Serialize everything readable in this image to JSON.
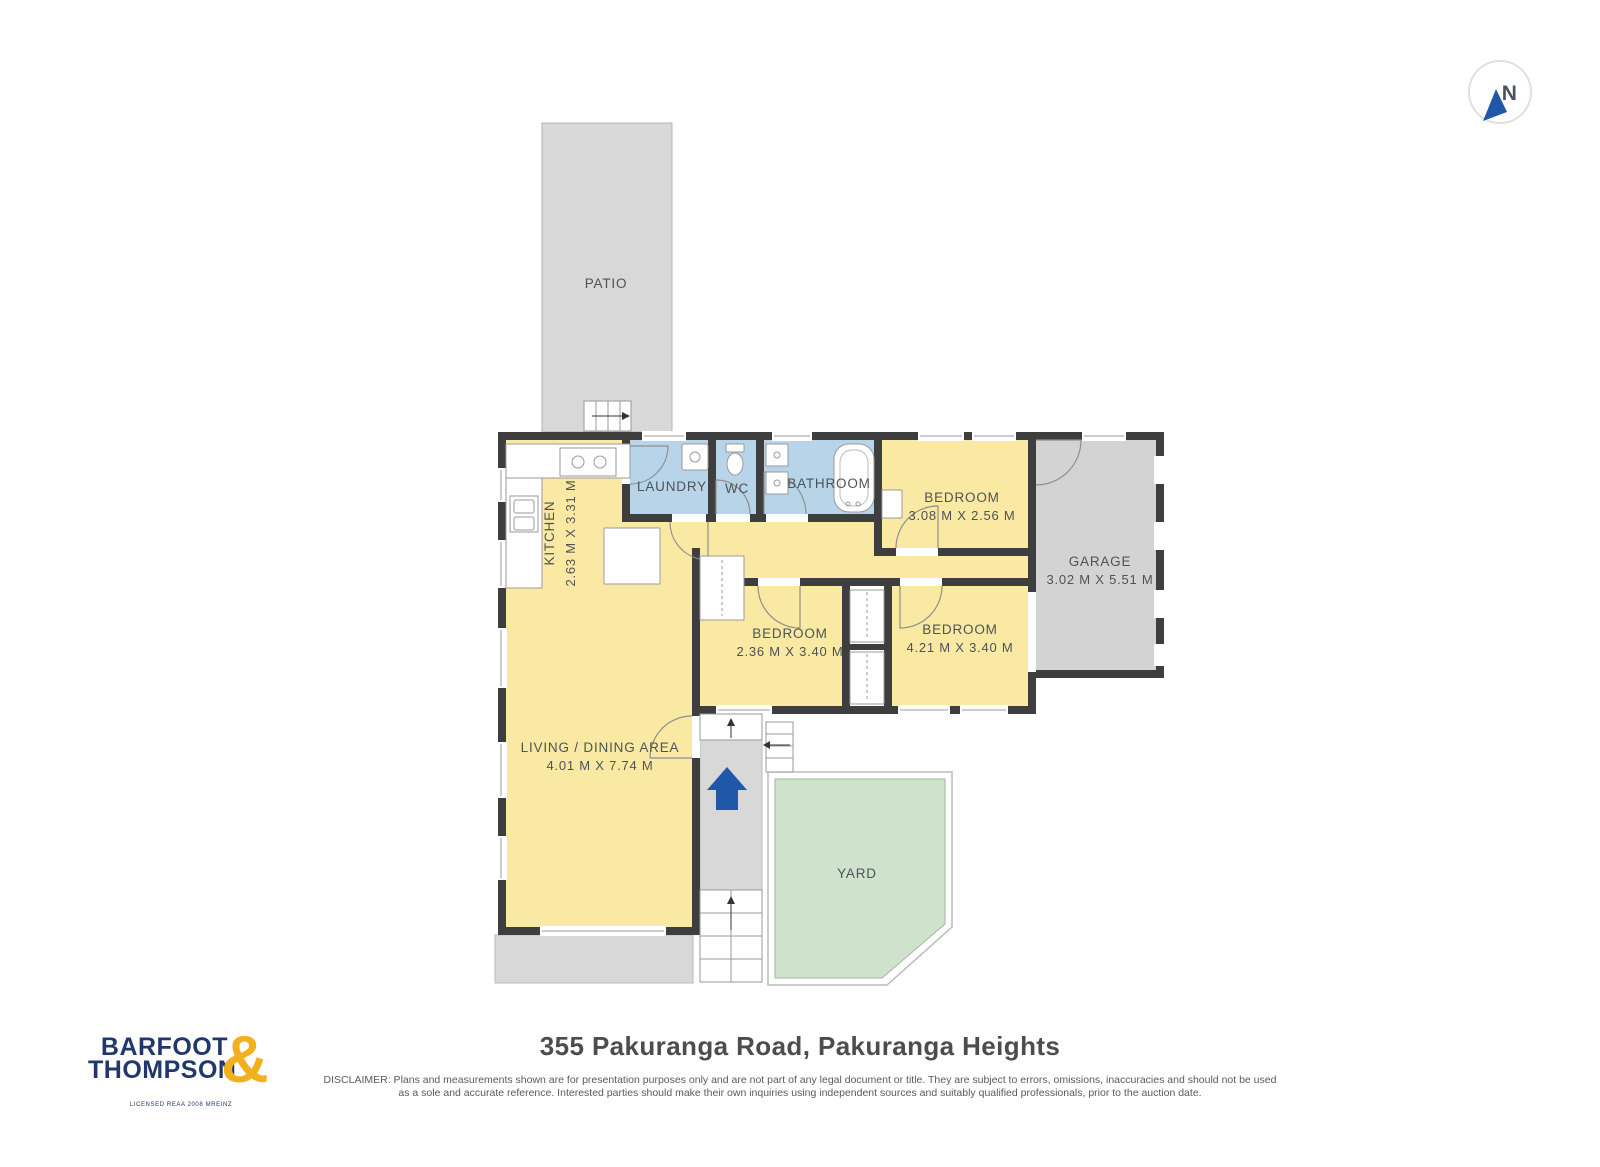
{
  "compass": {
    "n_label": "N"
  },
  "plan": {
    "patio_label": "PATIO",
    "yard_label": "YARD",
    "rooms": {
      "kitchen": {
        "name": "KITCHEN",
        "dims": "2.63 M X 3.31 M"
      },
      "laundry": {
        "name": "LAUNDRY"
      },
      "wc": {
        "name": "WC"
      },
      "bathroom": {
        "name": "BATHROOM"
      },
      "bedroom_top": {
        "name": "BEDROOM",
        "dims": "3.08 M X 2.56 M"
      },
      "garage": {
        "name": "GARAGE",
        "dims": "3.02 M X 5.51 M"
      },
      "bedroom_mid": {
        "name": "BEDROOM",
        "dims": "2.36 M X 3.40 M"
      },
      "bedroom_right": {
        "name": "BEDROOM",
        "dims": "4.21 M X 3.40 M"
      },
      "living": {
        "name": "LIVING / DINING AREA",
        "dims": "4.01 M X 7.74 M"
      }
    }
  },
  "footer": {
    "logo": {
      "line1": "BARFOOT",
      "line2": "THOMPSON",
      "ampersand": "&",
      "tagline": "LICENSED REAA 2008 MREINZ"
    },
    "title": "355 Pakuranga Road, Pakuranga Heights",
    "disclaimer_line1": "DISCLAIMER: Plans and measurements shown are for presentation purposes only and are not part of any legal document or title. They are subject to errors, omissions, inaccuracies and should not be used",
    "disclaimer_line2": "as a sole and accurate reference. Interested parties should make their own inquiries using independent sources and suitably qualified professionals, prior to the auction date."
  },
  "colors": {
    "wall": "#3e3e3e",
    "room_yellow": "#fae9a2",
    "room_blue": "#b7d4e8",
    "outdoor_gray": "#d8d8d8",
    "garage_gray": "#d3d3d3",
    "yard_green": "#cfe2cc",
    "accent_blue": "#2157a8",
    "logo_navy": "#20386b",
    "logo_gold": "#f2b01e"
  }
}
